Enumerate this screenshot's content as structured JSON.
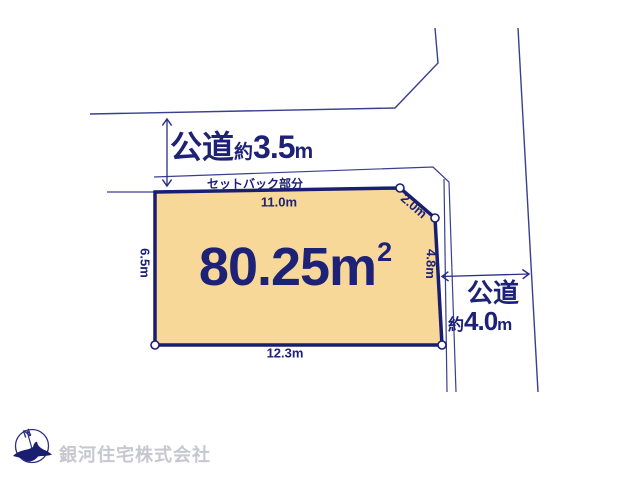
{
  "colors": {
    "navy_text": "#1e2277",
    "thin_line": "#3a3f8f",
    "plot_fill": "#f7d898",
    "plot_border": "#1a1e72",
    "company_gray": "#c7c7cf",
    "background": "#ffffff"
  },
  "roads": {
    "top": {
      "name": "公道",
      "approx_prefix": "約",
      "width_value": "3.5",
      "unit": "m"
    },
    "right": {
      "name": "公道",
      "approx_prefix": "約",
      "width_value": "4.0",
      "unit": "m"
    }
  },
  "plot": {
    "area_value": "80.25",
    "area_unit": "m",
    "area_exponent": "2",
    "setback_label": "セットバック部分",
    "dimensions": {
      "top": "11.0m",
      "bottom": "12.3m",
      "left": "6.5m",
      "right": "4.8m",
      "corner": "2.0m"
    }
  },
  "compass": {
    "north_label": "N"
  },
  "footer": {
    "company_name": "銀河住宅株式会社"
  }
}
